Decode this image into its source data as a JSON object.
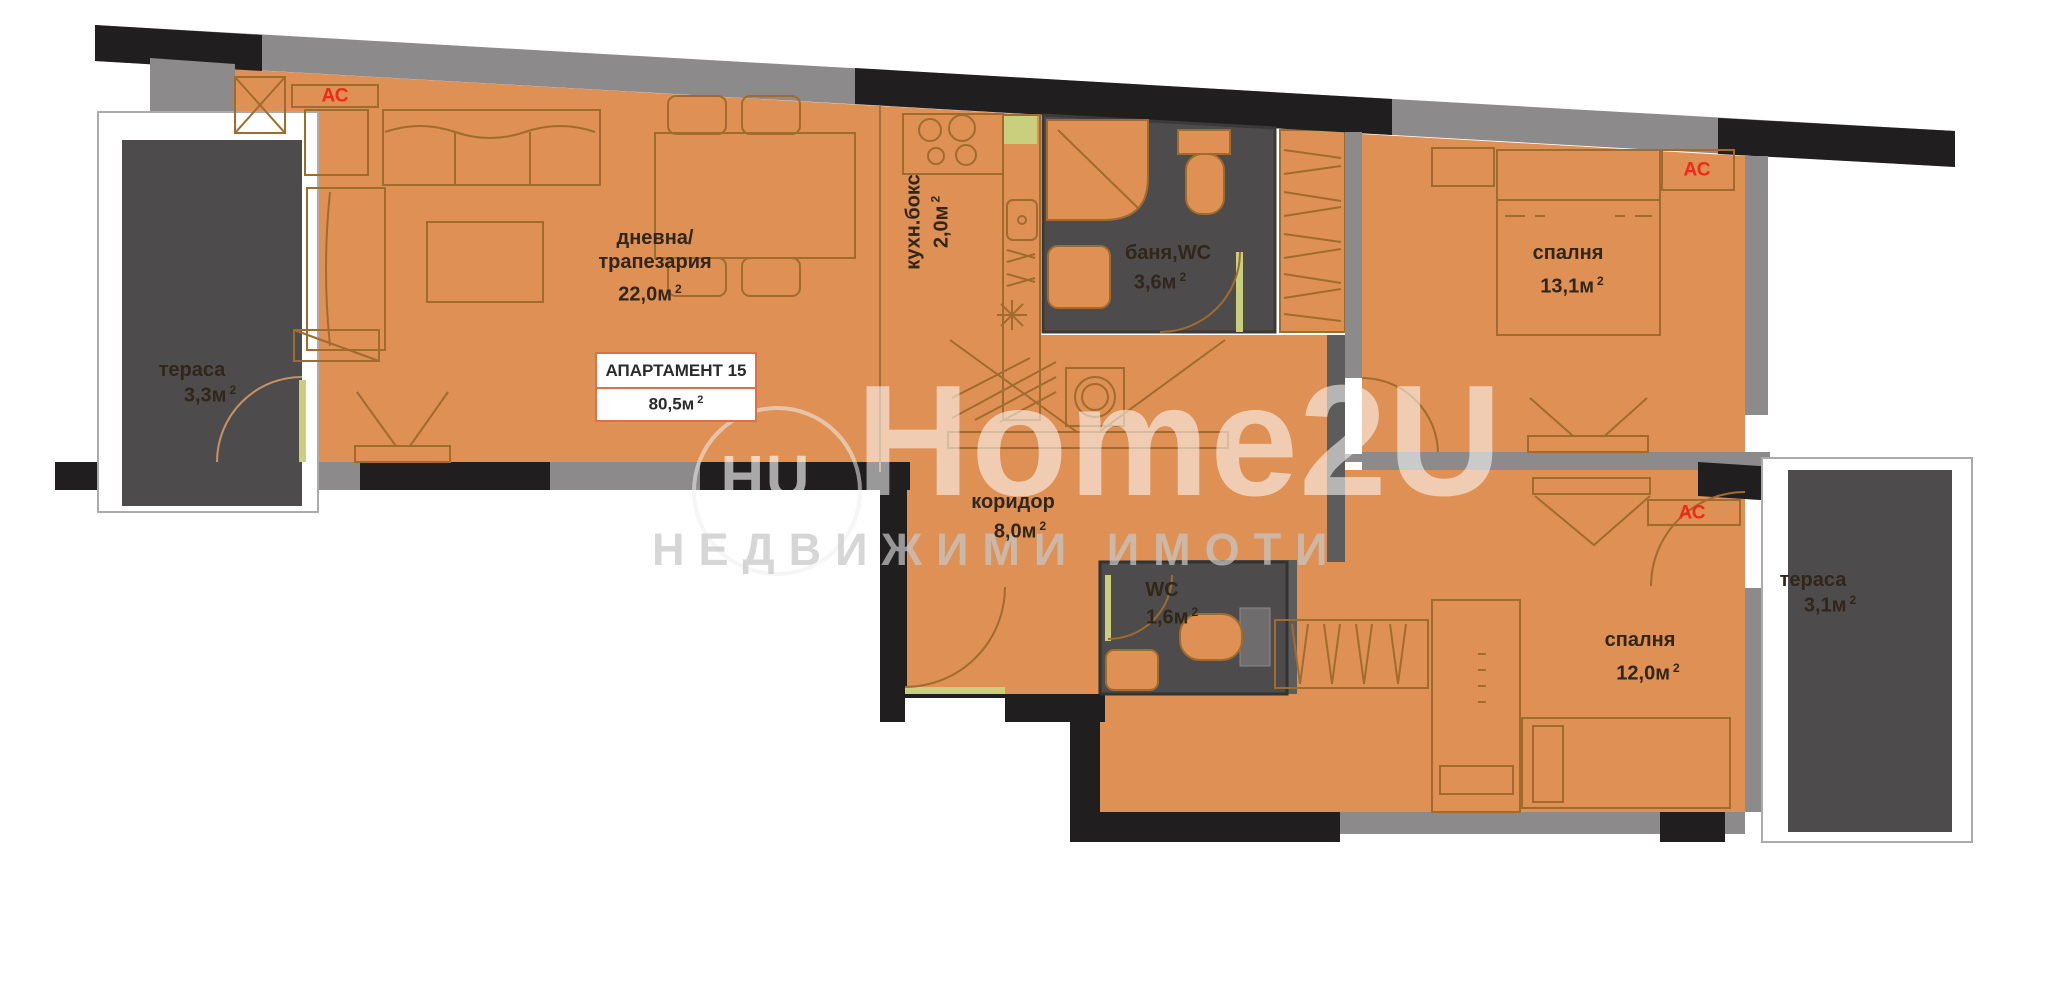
{
  "apartment_box": {
    "title": "АПАРТАМЕНТ 15",
    "area": "80,5м",
    "sup": "2"
  },
  "ac_label": "АС",
  "rooms": {
    "living": {
      "name1": "дневна/",
      "name2": "трапезария",
      "area": "22,0м",
      "sup": "2"
    },
    "kitchen": {
      "name": "кухн.бокс",
      "area": "2,0м",
      "sup": "2"
    },
    "bath": {
      "name": "баня,WC",
      "area": "3,6м",
      "sup": "2"
    },
    "bedroom1": {
      "name": "спалня",
      "area": "13,1м",
      "sup": "2"
    },
    "corridor": {
      "name": "коридор",
      "area": "8,0м",
      "sup": "2"
    },
    "wc": {
      "name": "WC",
      "area": "1,6м",
      "sup": "2"
    },
    "bedroom2": {
      "name": "спалня",
      "area": "12,0м",
      "sup": "2"
    },
    "terrace_left": {
      "name": "тераса",
      "area": "3,3м",
      "sup": "2"
    },
    "terrace_right": {
      "name": "тераса",
      "area": "3,1м",
      "sup": "2"
    }
  },
  "watermark": {
    "logo_text": "HU",
    "logo_number": "2",
    "brand": "Home2U",
    "tagline": "НЕДВИЖИМИ  ИМОТИ"
  },
  "colors": {
    "floor": "#DE9055",
    "wall_black": "#201E1F",
    "wall_gray": "#8C8A8B",
    "dark_room": "#4D4B4C",
    "accent_red": "#F3281A",
    "furniture_line": "#A06C2E",
    "door_leaf": "#C9CF7D",
    "info_border": "#DD6F4D"
  }
}
